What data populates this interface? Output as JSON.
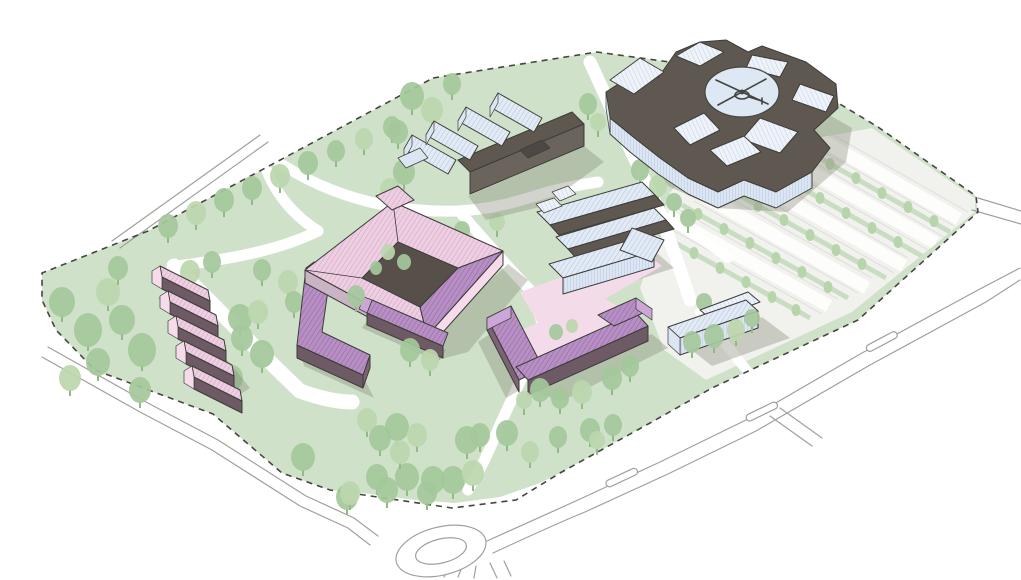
{
  "meta": {
    "title": "Campus site masterplan — axonometric aerial illustration",
    "canvas": {
      "width": 1021,
      "height": 580
    }
  },
  "palette": {
    "green_area": "#cfe2c9",
    "parking_base": "#f1f1ee",
    "parking_strip": "#c9ddc2",
    "plaza_pink": "#f4dbe9",
    "courtyard_dark": "#57504a",
    "dark_roof": "#5f5851",
    "dark_roof2": "#4d4843",
    "dark_facade": "#6d5a64",
    "pink_wall": "#f6dcea",
    "pink_wall_shaded": "#eccade",
    "mauve_wall": "#cbb3c6",
    "purple_gable": "#cda6d8",
    "purple_side": "#7d6273",
    "blue_wall": "#dce6f3",
    "blue_wall_light": "#e9eff8",
    "blue_wall_line": "#b9c8e0",
    "blue_roof": "#e2eaf5",
    "blue_roof_line": "#b3c3dc",
    "blue_roof_light": "#eef2f9",
    "blue_roof_light_line": "#c4d1e6",
    "pink_roof": "#eecfe2",
    "pink_roof_line": "#d2a4c4",
    "purple_roof": "#b88fc5",
    "purple_roof_line": "#8f6a9e",
    "helipad": "#dde8f4",
    "heli_ink": "#45453f",
    "road_line": "#a0a09b",
    "boundary": "#46463f",
    "shadow": "#8a8b78",
    "tree_mid": "#a4c89b",
    "tree_light": "#bcd7ae",
    "tree_dark": "#96bf8c",
    "tree_parking": "#b7d5ab",
    "tree_trunk": "#8fbb84",
    "outline": "#3c3c38"
  },
  "legend": {
    "site_elements": [
      {
        "id": "main-hospital",
        "description": "large light-blue hospital block with rooftop helipad",
        "top_right": true
      },
      {
        "id": "finger-clinic-building",
        "description": "light-blue comb-shaped building with four wings"
      },
      {
        "id": "central-blue-complex",
        "description": "light-blue bar cluster with dark link roofs"
      },
      {
        "id": "pink-courtyard-block",
        "description": "pink perimeter block with dark inner courtyard"
      },
      {
        "id": "purple-l-building",
        "description": "purple L-shaped block"
      },
      {
        "id": "purple-bar-building",
        "description": "small purple bar south of courtyard block"
      },
      {
        "id": "purple-u-building",
        "description": "purple U-shaped block around pink plaza"
      },
      {
        "id": "small-blue-building",
        "description": "small gabled light-blue building"
      },
      {
        "id": "terraced-houses",
        "description": "row of five stepped pink houses"
      },
      {
        "id": "parking-lot",
        "description": "tree-lined surface parking rows"
      },
      {
        "id": "site-boundary",
        "description": "dashed site boundary line"
      },
      {
        "id": "roundabout",
        "description": "road roundabout at bottom"
      }
    ]
  },
  "trees": {
    "large_behind": [
      [
        168,
        226,
        10,
        "m"
      ],
      [
        196,
        213,
        10,
        "l"
      ],
      [
        224,
        200,
        10,
        "m"
      ],
      [
        252,
        188,
        10,
        "m"
      ],
      [
        280,
        176,
        10,
        "l"
      ],
      [
        308,
        163,
        10,
        "m"
      ],
      [
        336,
        151,
        9,
        "m"
      ],
      [
        364,
        139,
        9,
        "l"
      ],
      [
        392,
        127,
        9,
        "m"
      ],
      [
        412,
        96,
        12,
        "m"
      ],
      [
        432,
        110,
        11,
        "l"
      ],
      [
        398,
        132,
        10,
        "m"
      ],
      [
        404,
        172,
        11,
        "m"
      ],
      [
        390,
        190,
        10,
        "l"
      ],
      [
        452,
        84,
        9,
        "m"
      ],
      [
        588,
        104,
        9,
        "m"
      ],
      [
        598,
        122,
        8,
        "l"
      ],
      [
        640,
        170,
        9,
        "m"
      ],
      [
        658,
        186,
        9,
        "l"
      ],
      [
        674,
        202,
        8,
        "m"
      ],
      [
        688,
        218,
        8,
        "m"
      ],
      [
        62,
        302,
        13,
        "m"
      ],
      [
        88,
        330,
        14,
        "m"
      ],
      [
        108,
        292,
        12,
        "l"
      ],
      [
        122,
        320,
        13,
        "m"
      ],
      [
        142,
        350,
        14,
        "m"
      ],
      [
        98,
        362,
        12,
        "m"
      ],
      [
        70,
        378,
        11,
        "l"
      ],
      [
        140,
        390,
        11,
        "m"
      ],
      [
        118,
        268,
        10,
        "m"
      ],
      [
        190,
        272,
        10,
        "l"
      ],
      [
        212,
        262,
        9,
        "m"
      ],
      [
        240,
        318,
        12,
        "m"
      ],
      [
        258,
        312,
        10,
        "l"
      ],
      [
        242,
        338,
        11,
        "m"
      ],
      [
        262,
        354,
        12,
        "m"
      ],
      [
        232,
        378,
        11,
        "m"
      ],
      [
        288,
        282,
        10,
        "l"
      ],
      [
        262,
        270,
        9,
        "m"
      ],
      [
        294,
        302,
        9,
        "m"
      ],
      [
        462,
        230,
        8,
        "m"
      ],
      [
        497,
        222,
        8,
        "l"
      ],
      [
        704,
        302,
        8,
        "m"
      ],
      [
        303,
        457,
        12,
        "m"
      ],
      [
        347,
        497,
        11,
        "m"
      ],
      [
        367,
        420,
        10,
        "l"
      ],
      [
        380,
        438,
        11,
        "m"
      ],
      [
        397,
        427,
        12,
        "m"
      ],
      [
        417,
        435,
        10,
        "l"
      ],
      [
        433,
        480,
        12,
        "m"
      ],
      [
        377,
        477,
        11,
        "m"
      ],
      [
        350,
        493,
        10,
        "l"
      ],
      [
        387,
        490,
        11,
        "m"
      ],
      [
        407,
        477,
        12,
        "m"
      ],
      [
        427,
        493,
        10,
        "m"
      ],
      [
        453,
        480,
        12,
        "m"
      ],
      [
        473,
        473,
        11,
        "l"
      ],
      [
        467,
        440,
        12,
        "m"
      ],
      [
        400,
        452,
        10,
        "l"
      ],
      [
        480,
        435,
        10,
        "m"
      ],
      [
        507,
        433,
        11,
        "m"
      ],
      [
        530,
        452,
        9,
        "l"
      ],
      [
        590,
        430,
        10,
        "m"
      ],
      [
        613,
        425,
        9,
        "m"
      ],
      [
        597,
        440,
        8,
        "l"
      ],
      [
        558,
        437,
        9,
        "m"
      ]
    ],
    "large_front": [
      [
        388,
        252,
        7,
        "l"
      ],
      [
        404,
        262,
        7,
        "m"
      ],
      [
        376,
        268,
        6,
        "m"
      ],
      [
        356,
        296,
        9,
        "m"
      ],
      [
        410,
        350,
        10,
        "m"
      ],
      [
        430,
        360,
        9,
        "l"
      ],
      [
        540,
        390,
        10,
        "m"
      ],
      [
        560,
        398,
        9,
        "m"
      ],
      [
        582,
        392,
        10,
        "l"
      ],
      [
        612,
        378,
        10,
        "m"
      ],
      [
        630,
        366,
        9,
        "m"
      ],
      [
        524,
        400,
        8,
        "l"
      ],
      [
        556,
        332,
        7,
        "m"
      ],
      [
        572,
        326,
        6,
        "l"
      ],
      [
        692,
        342,
        9,
        "m"
      ],
      [
        714,
        336,
        10,
        "m"
      ],
      [
        736,
        330,
        9,
        "l"
      ],
      [
        752,
        318,
        8,
        "m"
      ]
    ],
    "parking": [
      [
        668,
        239
      ],
      [
        694,
        253
      ],
      [
        720,
        268
      ],
      [
        746,
        282
      ],
      [
        772,
        297
      ],
      [
        796,
        310
      ],
      [
        698,
        214
      ],
      [
        724,
        229
      ],
      [
        750,
        243
      ],
      [
        776,
        258
      ],
      [
        802,
        272
      ],
      [
        828,
        287
      ],
      [
        732,
        191
      ],
      [
        758,
        206
      ],
      [
        784,
        220
      ],
      [
        810,
        235
      ],
      [
        836,
        250
      ],
      [
        862,
        264
      ],
      [
        768,
        169
      ],
      [
        794,
        184
      ],
      [
        820,
        198
      ],
      [
        846,
        213
      ],
      [
        872,
        228
      ],
      [
        898,
        242
      ],
      [
        804,
        149
      ],
      [
        830,
        164
      ],
      [
        856,
        178
      ],
      [
        882,
        193
      ],
      [
        908,
        207
      ],
      [
        934,
        221
      ]
    ]
  },
  "parking_config": {
    "row_count": 5,
    "trees_per_row": 6
  }
}
